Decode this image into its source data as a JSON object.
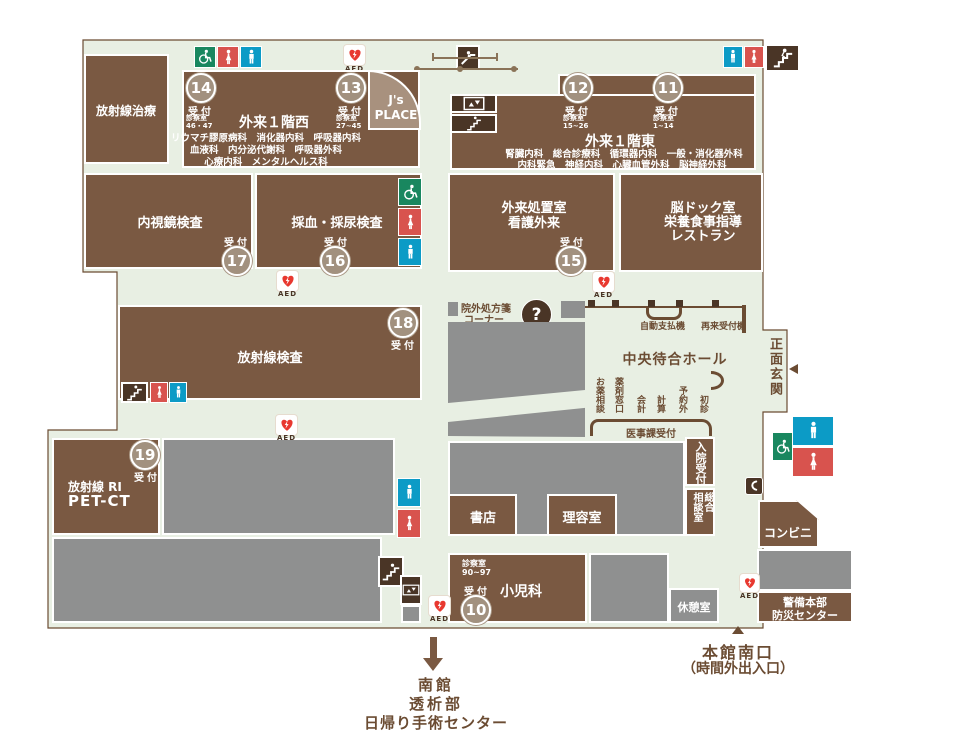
{
  "colors": {
    "floor": "#e8efe3",
    "room_brown": "#7a5942",
    "gray": "#8f9090",
    "icon_dark": "#4a3526",
    "badge": "#a2917f",
    "accessible_green": "#19875f",
    "female_red": "#d8534e",
    "male_blue": "#0c9bc6",
    "text_brown": "#6b4c33",
    "light_brown": "#a8917e",
    "aed_red": "#e8382f"
  },
  "rooms": {
    "radiation_therapy": {
      "label": "放射線治療"
    },
    "west": {
      "title": "外来１階西",
      "dept_line1": "リウマチ膠原病科　消化器内科　呼吸器内科",
      "dept_line2": "血液科　内分泌代謝科　呼吸器外科",
      "dept_line3": "心療内科　メンタルヘルス科"
    },
    "js_place": {
      "line1": "J's",
      "line2": "PLACE"
    },
    "east": {
      "title": "外来１階東",
      "dept_line1": "腎臓内科　総合診療科　循環器内科　一般・消化器外科",
      "dept_line2": "内科緊急　神経内科　心臓血管外科　脳神経外科"
    },
    "endoscopy": {
      "label": "内視鏡検査"
    },
    "blood_urine": {
      "label": "採血・採尿検査"
    },
    "treatment": {
      "line1": "外来処置室",
      "line2": "看護外来"
    },
    "brain_dock": {
      "line1": "脳ドック室",
      "line2": "栄養食事指導",
      "line3": "レストラン"
    },
    "radiology": {
      "label": "放射線検査"
    },
    "ri_petct": {
      "line1": "放射線 RI",
      "line2": "PET-CT"
    },
    "bookstore": {
      "label": "書店"
    },
    "barber": {
      "label": "理容室"
    },
    "pediatrics": {
      "label": "小児科",
      "rooms_label": "診察室",
      "rooms": "90~97"
    },
    "rest_room": {
      "label": "休憩室"
    },
    "convenience": {
      "label": "コンビニ"
    },
    "security": {
      "line1": "警備本部",
      "line2": "防災センター"
    },
    "admission": {
      "label": "入院受付"
    },
    "consultation": {
      "col_right": "総合",
      "col_left": "相談室"
    }
  },
  "receptions": {
    "r14": {
      "number": "14",
      "label": "受付",
      "rooms_label": "診察室",
      "rooms": "46・47"
    },
    "r13": {
      "number": "13",
      "label": "受付",
      "rooms_label": "診察室",
      "rooms": "27~45"
    },
    "r12": {
      "number": "12",
      "label": "受付",
      "rooms_label": "診察室",
      "rooms": "15~26"
    },
    "r11": {
      "number": "11",
      "label": "受付",
      "rooms_label": "診察室",
      "rooms": "1~14"
    },
    "r17": {
      "number": "17",
      "label": "受付"
    },
    "r16": {
      "number": "16",
      "label": "受付"
    },
    "r15": {
      "number": "15",
      "label": "受付"
    },
    "r18": {
      "number": "18",
      "label": "受付"
    },
    "r19": {
      "number": "19",
      "label": "受付"
    },
    "r10": {
      "number": "10",
      "label": "受付"
    }
  },
  "hall": {
    "prescription_line1": "院外処方箋",
    "prescription_line2": "コーナー",
    "information_line1": "インフォメーション",
    "information_line2": "（外来のご案内）",
    "payment": "自動支払機",
    "recheckin": "再来受付機",
    "central_hall": "中央待合ホール",
    "counters": [
      "お薬相談",
      "薬剤窓口",
      "会計",
      "計算",
      "予約外",
      "初診"
    ],
    "medical_affairs": "医事課受付",
    "main_entrance": "正面玄関"
  },
  "exits": {
    "south_line1": "本館南口",
    "south_line2": "（時間外出入口）",
    "annex_line1": "南館",
    "annex_line2": "透析部",
    "annex_line3": "日帰り手術センター"
  },
  "aed_label": "AED",
  "question_mark": "?"
}
